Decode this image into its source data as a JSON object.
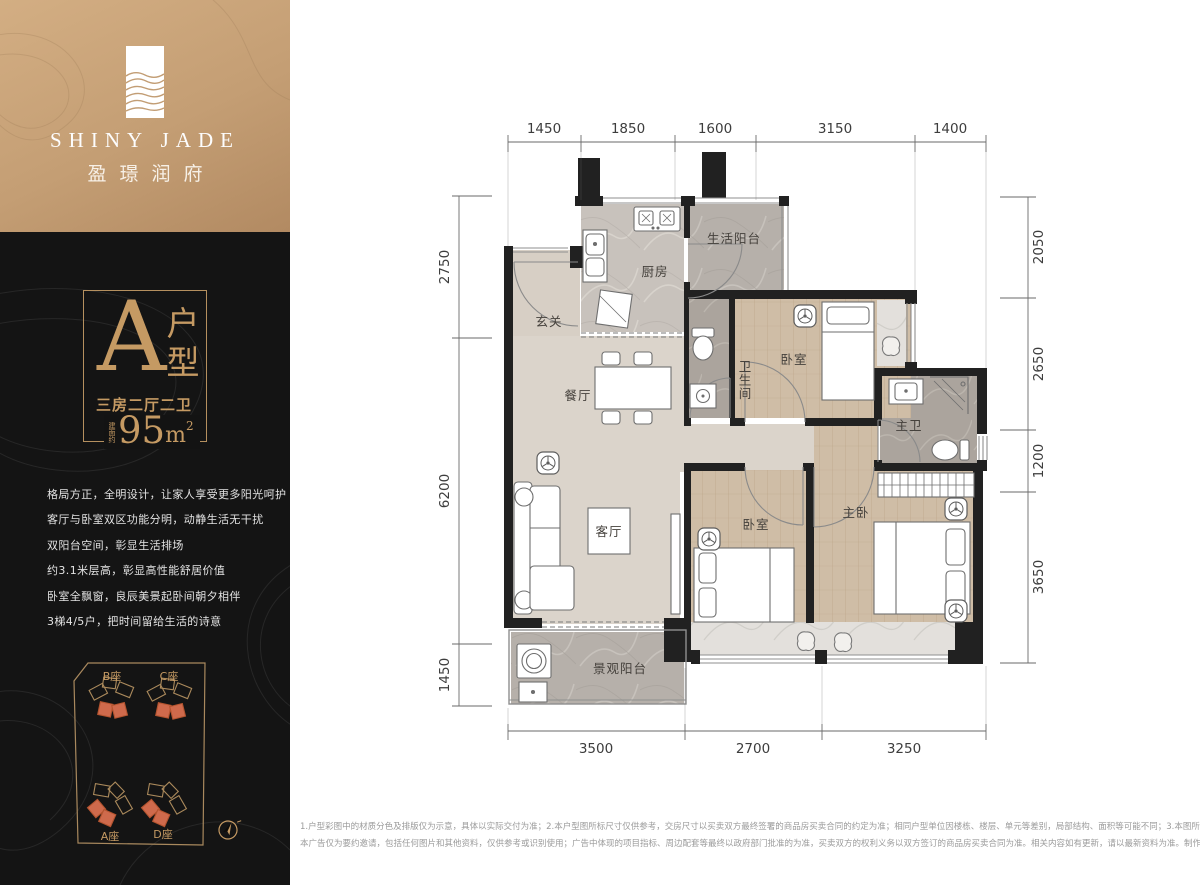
{
  "brand": {
    "en": "SHINY JADE",
    "cn": "盈璟润府"
  },
  "unit": {
    "letter": "A",
    "suffix": "户型",
    "layout": "三房二厅二卫",
    "area_prefix": "建面约",
    "area_num": "95",
    "area_unit": "m",
    "area_sup": "2"
  },
  "description": [
    "格局方正，全明设计，让家人享受更多阳光呵护",
    "客厅与卧室双区功能分明，动静生活无干扰",
    "双阳台空间，彰显生活排场",
    "约3.1米层高，彰显高性能舒居价值",
    "卧室全飘窗，良辰美景起卧间朝夕相伴",
    "3梯4/5户，把时间留给生活的诗意"
  ],
  "site": {
    "b": "B座",
    "c": "C座",
    "a": "A座",
    "d": "D座"
  },
  "rooms": {
    "entry": "玄关",
    "kitchen": "厨房",
    "service_balcony": "生活阳台",
    "dining": "餐厅",
    "bathroom": "卫生间",
    "bedroom_top": "卧室",
    "master_bathroom": "主卫",
    "living": "客厅",
    "bedroom_mid": "卧室",
    "master_bedroom": "主卧",
    "view_balcony": "景观阳台"
  },
  "dims": {
    "top": [
      "1450",
      "1850",
      "1600",
      "3150",
      "1400"
    ],
    "bottom": [
      "3500",
      "2700",
      "3250"
    ],
    "left": [
      "2750",
      "6200",
      "1450"
    ],
    "right": [
      "2050",
      "2650",
      "1200",
      "3650"
    ]
  },
  "disclaimer": {
    "line1": "1.户型彩图中的材质分色及排版仅为示意，具体以实际交付为准；2.本户型图所标尺寸仅供参考，交房尺寸以买卖双方最终签署的商品房买卖合同的约定为准；相同户型单位因楼栋、楼层、单元等差别，局部结构、面积等可能不同；3.本图所示仅作为家具、电器等布置参考，非交楼标准；4.本户型图仅为装修示意图，展示户内空间结构。",
    "line2": "本广告仅为要约邀请，包括任何图片和其他资料，仅供参考或识别使用；广告中体现的项目指标、周边配套等最终以政府部门批准的为准，买卖双方的权利义务以双方签订的商品房买卖合同为准。相关内容如有更新，请以最新资料为准。制作时间：2021年9月"
  },
  "colors": {
    "gold": "#c59a63",
    "panel": "#141414",
    "orange": "#cf6a4c",
    "wall": "#212121"
  }
}
